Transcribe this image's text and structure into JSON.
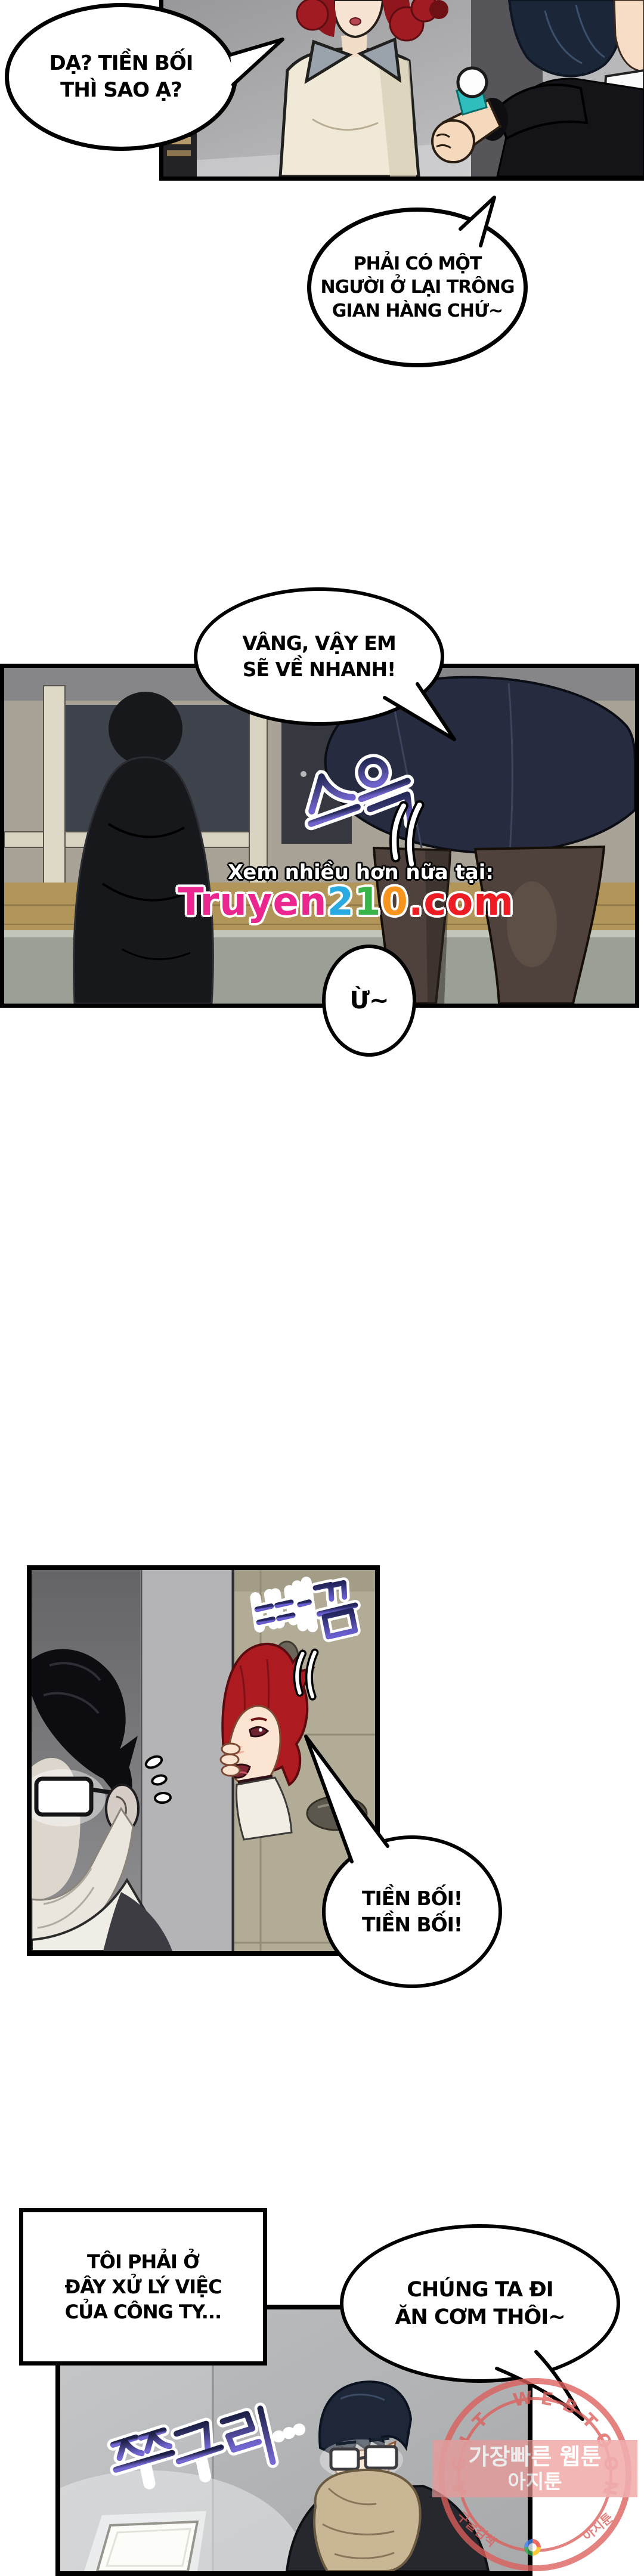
{
  "page": {
    "type": "webtoon comic page",
    "background": "#ffffff"
  },
  "bubbles": {
    "b1": {
      "lines": [
        "DẠ? TIỀN BỐI",
        "THÌ SAO Ạ?"
      ]
    },
    "b2": {
      "lines": [
        "PHẢI CÓ MỘT",
        "NGƯỜI Ở LẠI TRÔNG",
        "GIAN HÀNG CHỨ~"
      ]
    },
    "b3": {
      "lines": [
        "VÂNG, VẬY EM",
        "SẼ VỀ NHANH!"
      ]
    },
    "b4": {
      "text": "Ừ~"
    },
    "b5": {
      "lines": [
        "TIỀN BỐI!",
        "TIỀN BỐI!"
      ]
    },
    "box": {
      "lines": [
        "TÔI PHẢI Ở",
        "ĐÂY XỬ LÝ VIỆC",
        "CỦA CÔNG TY..."
      ]
    },
    "b6": {
      "lines": [
        "CHÚNG TA ĐI",
        "ĂN CƠM THÔI~"
      ]
    }
  },
  "sfx": {
    "slide": "스윽",
    "peek": "빼꼼",
    "crouch": "쭈구리…",
    "gradient_top": "#23255c",
    "gradient_bottom": "#7064cc"
  },
  "watermark": {
    "tagline": "Xem nhiều hơn nữa tại:",
    "site": {
      "part1": "Truyen",
      "part2": "2",
      "part3": "1",
      "part4": "0",
      "part5": ".com"
    },
    "site_colors": {
      "part1": "#ec268f",
      "part2": "#29abe2",
      "part3": "#3ab54a",
      "part4": "#f7941e",
      "part5": "#ed1c24"
    }
  },
  "stamp": {
    "arc_text": "AGIT WEBTOON",
    "banner_line1": "가장빠른 웹툰",
    "banner_line2": "아지툰",
    "side_left": "구글검색",
    "side_right": "아지툰",
    "color": "#dd5f5c"
  },
  "colors": {
    "bubble_border": "#000000",
    "panel_border": "#000000",
    "skirt_navy": "#262b3f",
    "hair_red": "#ad1a20",
    "hair_navy": "#1d2737",
    "locker_beige": "#b2ab96",
    "watch_band_teal": "#2fbdbd"
  }
}
